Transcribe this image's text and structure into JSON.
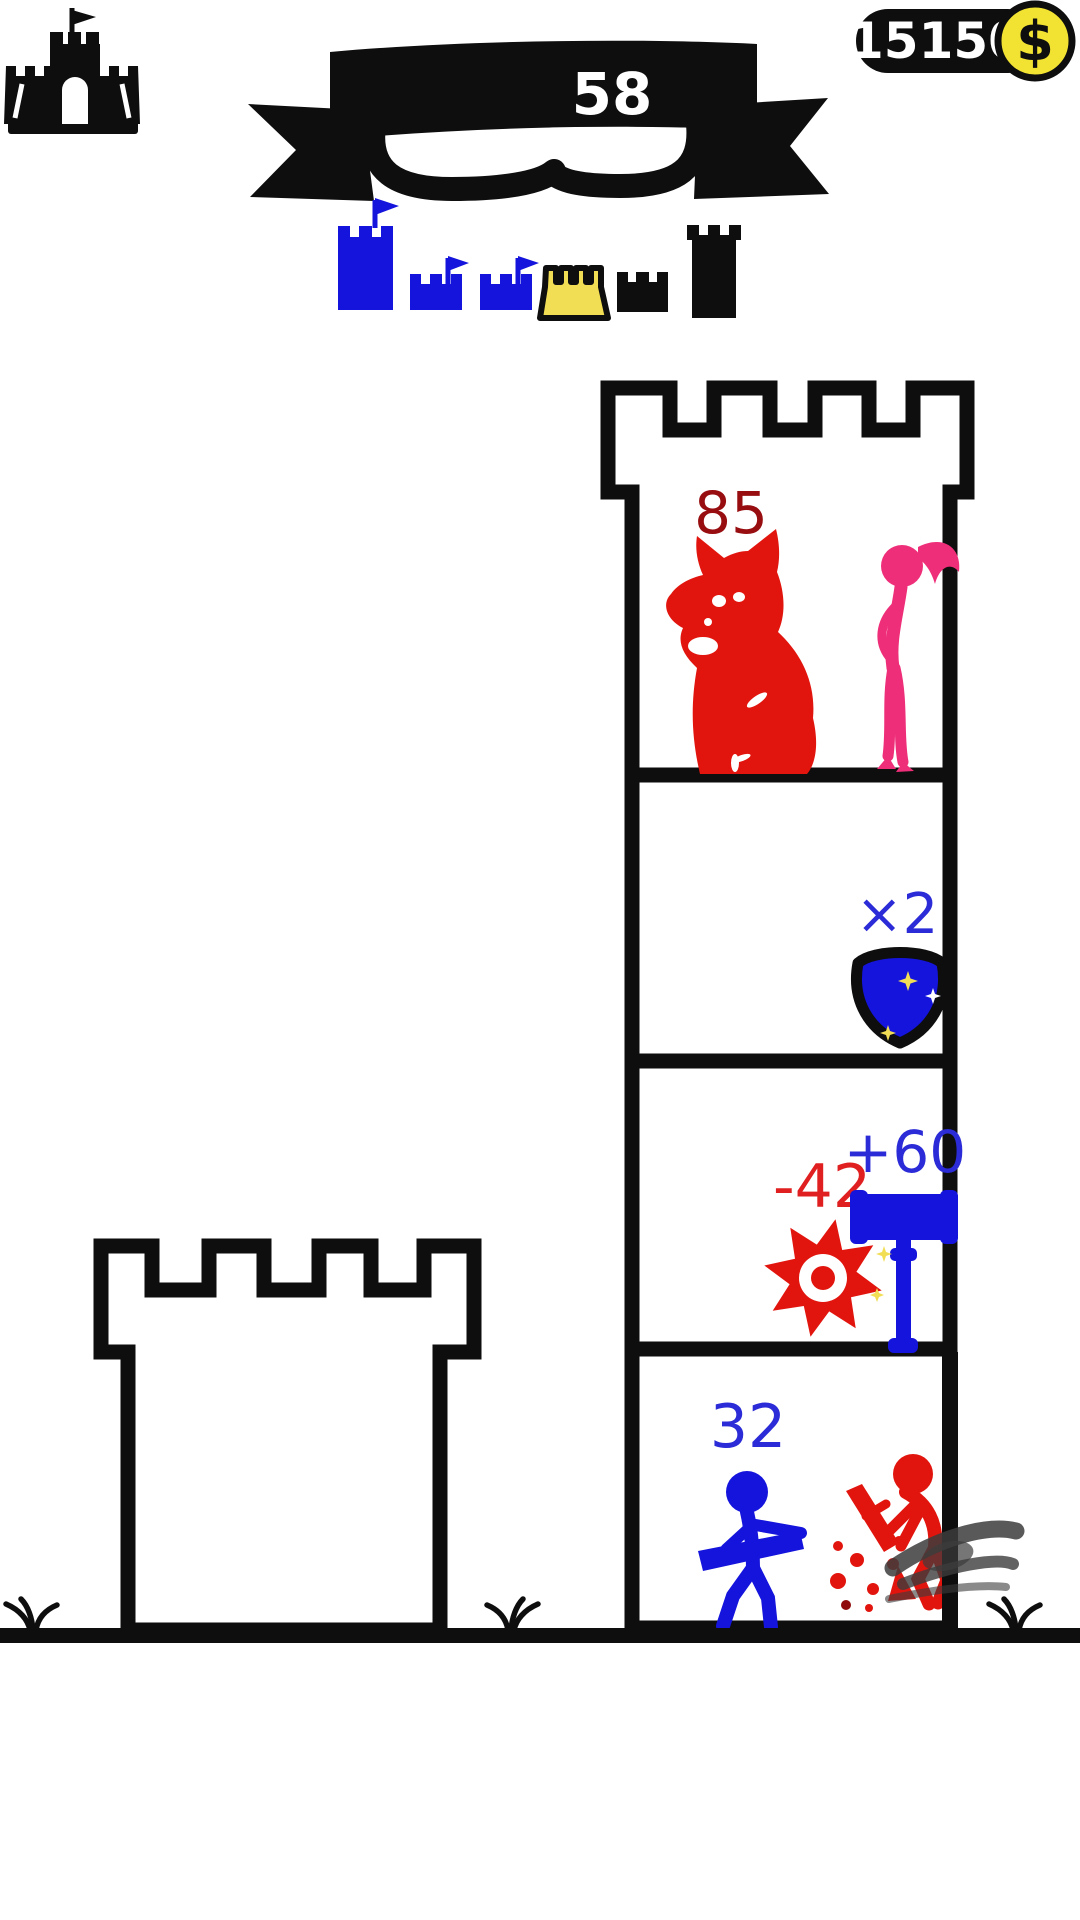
{
  "palette": {
    "black": "#0e0e0e",
    "white": "#ffffff",
    "blue": "#1414dd",
    "blue_text": "#2b2bd8",
    "red": "#e2150e",
    "red_dark": "#970d10",
    "red_text": "#e02020",
    "dark_red_drop": "#8f0a0a",
    "pink": "#ef2e79",
    "yellow": "#f2de55",
    "coin_yellow": "#f2e332",
    "smoke_gray": "#3c3c3c"
  },
  "hud": {
    "castle_button_icon": "castle-icon",
    "level_banner": {
      "level": "58"
    },
    "coin_counter": {
      "amount": "15150",
      "currency_symbol": "$",
      "coin_icon": "dollar-coin-icon"
    }
  },
  "level_progress": {
    "castles": [
      {
        "shape": "tall-tower",
        "color": "#1414dd",
        "flag": true,
        "state": "done"
      },
      {
        "shape": "small-castle",
        "color": "#1414dd",
        "flag": true,
        "state": "done"
      },
      {
        "shape": "small-castle",
        "color": "#1414dd",
        "flag": true,
        "state": "done"
      },
      {
        "shape": "wide-castle",
        "color": "#f2de55",
        "flag": false,
        "state": "current"
      },
      {
        "shape": "small-castle",
        "color": "#0e0e0e",
        "flag": false,
        "state": "upcoming"
      },
      {
        "shape": "tall-tower",
        "color": "#0e0e0e",
        "flag": false,
        "state": "upcoming"
      }
    ]
  },
  "tower": {
    "floors": [
      {
        "id": "floor-1-top",
        "hp": "85",
        "units": [
          "red-demon-cat",
          "pink-girl"
        ]
      },
      {
        "id": "floor-2",
        "multiplier": "×2",
        "item": "blue-shield"
      },
      {
        "id": "floor-3",
        "damage": "-42",
        "bonus": "+60",
        "items": [
          "red-saw-blade",
          "blue-hammer"
        ]
      },
      {
        "id": "floor-4-bottom",
        "hp": "32",
        "units": [
          "blue-hero",
          "red-enemy-defeated"
        ]
      }
    ]
  }
}
